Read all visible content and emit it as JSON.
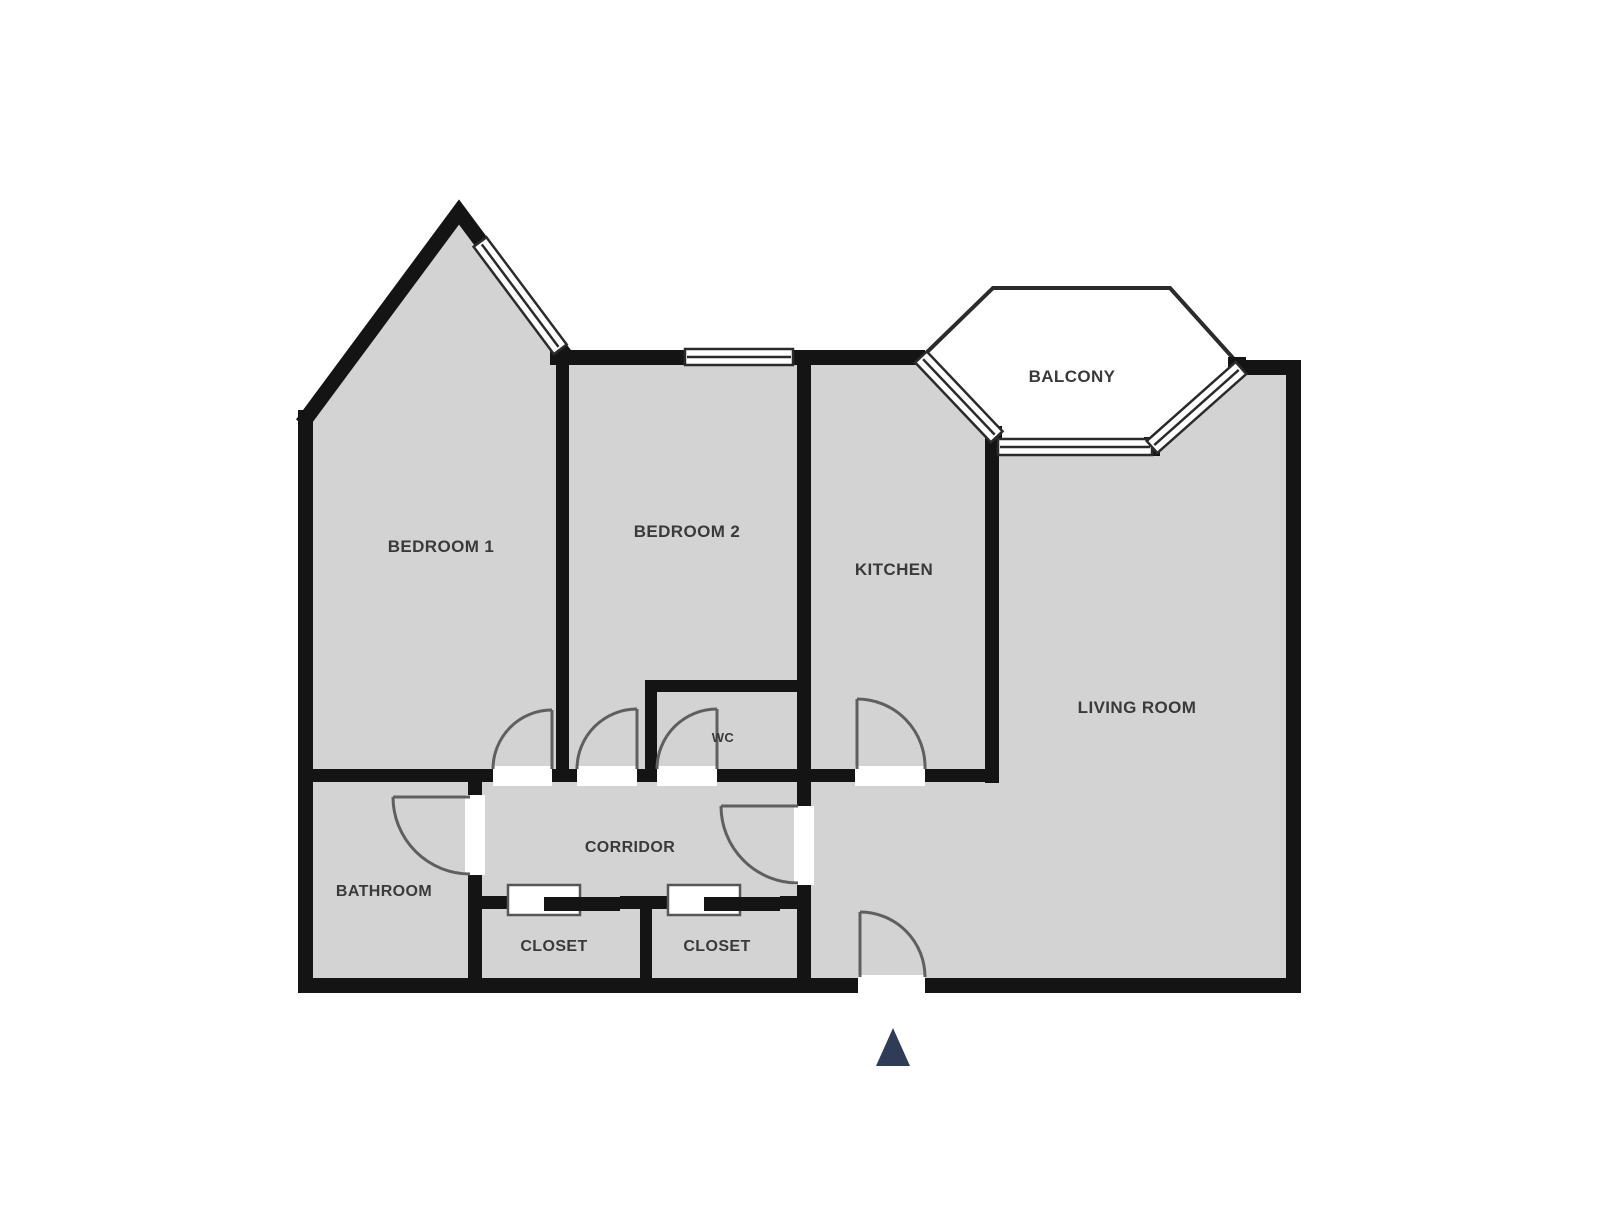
{
  "labels": {
    "bedroom1": "BEDROOM 1",
    "bedroom2": "BEDROOM 2",
    "kitchen": "KITCHEN",
    "balcony": "BALCONY",
    "living_room": "LIVING ROOM",
    "wc": "WC",
    "corridor": "CORRIDOR",
    "bathroom": "BATHROOM",
    "closet_left": "CLOSET",
    "closet_right": "CLOSET"
  },
  "colors": {
    "floor": "#d3d3d3",
    "wall": "#141414",
    "window_line": "#2b2b2b",
    "door_arc": "#5f5f5f",
    "label_text": "#3a3a3a",
    "entrance_marker": "#2e3c58",
    "background": "#ffffff"
  }
}
